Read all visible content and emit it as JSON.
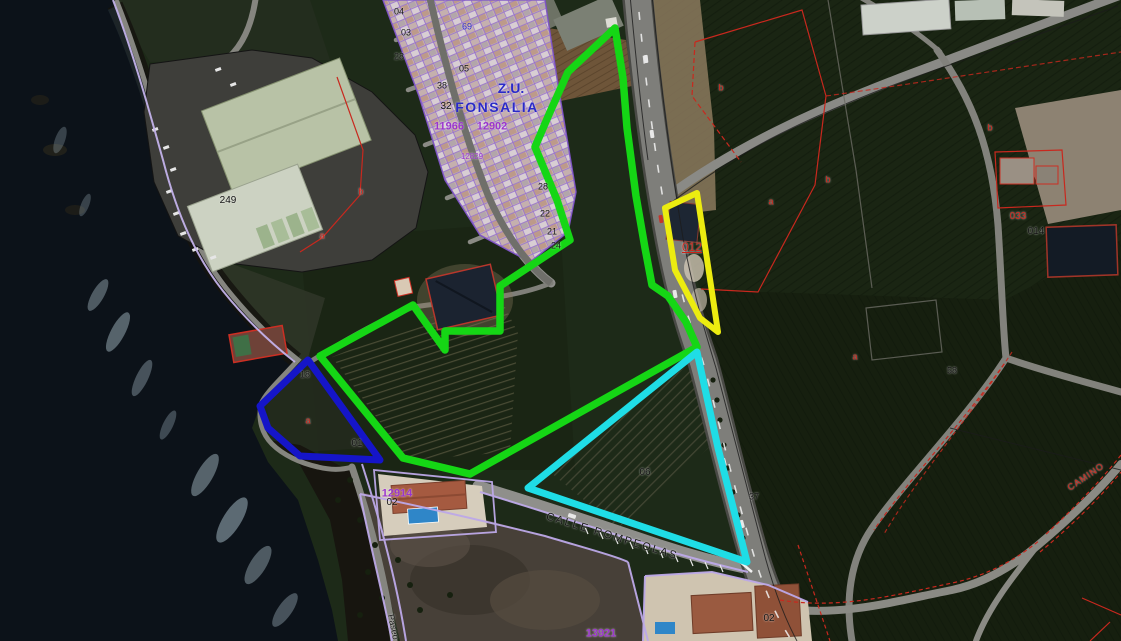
{
  "map": {
    "zone_label": "Z.U. FONSALIA",
    "parcels": [
      {
        "id": "green",
        "color": "#15d615"
      },
      {
        "id": "cyan",
        "color": "#1fdde6"
      },
      {
        "id": "yellow",
        "color": "#ecec10"
      },
      {
        "id": "blue",
        "color": "#1515c8"
      }
    ],
    "labels": [
      {
        "text": "Z.U.",
        "x": 511,
        "y": 88,
        "color": "#2a2ac8",
        "size": 14,
        "bold": true
      },
      {
        "text": "FONSALIA",
        "x": 497,
        "y": 107,
        "color": "#2a2ac8",
        "size": 14,
        "bold": true,
        "spacing": 1.5
      },
      {
        "text": "69",
        "x": 467,
        "y": 27,
        "color": "#2a2ac8",
        "size": 9
      },
      {
        "text": "11966",
        "x": 449,
        "y": 127,
        "color": "#9a35cc",
        "size": 11,
        "bold": true
      },
      {
        "text": "12902",
        "x": 492,
        "y": 127,
        "color": "#9a35cc",
        "size": 11,
        "bold": true
      },
      {
        "text": "12829",
        "x": 472,
        "y": 157,
        "color": "#9a35cc",
        "size": 8
      },
      {
        "text": "04",
        "x": 399,
        "y": 12,
        "color": "#111111",
        "size": 9
      },
      {
        "text": "03",
        "x": 406,
        "y": 33,
        "color": "#111111",
        "size": 9
      },
      {
        "text": "28",
        "x": 399,
        "y": 57,
        "color": "#111111",
        "size": 9
      },
      {
        "text": "05",
        "x": 464,
        "y": 69,
        "color": "#111111",
        "size": 9
      },
      {
        "text": "38",
        "x": 442,
        "y": 86,
        "color": "#111111",
        "size": 9
      },
      {
        "text": "32",
        "x": 446,
        "y": 107,
        "color": "#111111",
        "size": 10
      },
      {
        "text": "28",
        "x": 543,
        "y": 187,
        "color": "#111111",
        "size": 9
      },
      {
        "text": "22",
        "x": 545,
        "y": 214,
        "color": "#111111",
        "size": 9
      },
      {
        "text": "21",
        "x": 552,
        "y": 232,
        "color": "#111111",
        "size": 9
      },
      {
        "text": "24",
        "x": 556,
        "y": 246,
        "color": "#111111",
        "size": 9
      },
      {
        "text": "249",
        "x": 228,
        "y": 201,
        "color": "#111111",
        "size": 10
      },
      {
        "text": "b",
        "x": 361,
        "y": 192,
        "color": "#cc2218",
        "size": 9
      },
      {
        "text": "a",
        "x": 322,
        "y": 236,
        "color": "#cc2218",
        "size": 9
      },
      {
        "text": "012",
        "x": 692,
        "y": 247,
        "color": "#cc2218",
        "size": 12,
        "underline": true
      },
      {
        "text": "a",
        "x": 771,
        "y": 202,
        "color": "#cc2218",
        "size": 9
      },
      {
        "text": "b",
        "x": 721,
        "y": 88,
        "color": "#cc2218",
        "size": 9
      },
      {
        "text": "b",
        "x": 828,
        "y": 180,
        "color": "#cc2218",
        "size": 9
      },
      {
        "text": "a",
        "x": 855,
        "y": 357,
        "color": "#cc2218",
        "size": 9
      },
      {
        "text": "58",
        "x": 952,
        "y": 371,
        "color": "#111111",
        "size": 9
      },
      {
        "text": "b",
        "x": 990,
        "y": 128,
        "color": "#cc2218",
        "size": 9
      },
      {
        "text": "033",
        "x": 1018,
        "y": 217,
        "color": "#cc2218",
        "size": 10
      },
      {
        "text": "014",
        "x": 1036,
        "y": 232,
        "color": "#111111",
        "size": 10
      },
      {
        "text": "06",
        "x": 645,
        "y": 473,
        "color": "#111111",
        "size": 10
      },
      {
        "text": "37",
        "x": 754,
        "y": 497,
        "color": "#111111",
        "size": 9
      },
      {
        "text": "18",
        "x": 305,
        "y": 375,
        "color": "#111111",
        "size": 9
      },
      {
        "text": "a",
        "x": 308,
        "y": 421,
        "color": "#cc2218",
        "size": 9
      },
      {
        "text": "01",
        "x": 357,
        "y": 444,
        "color": "#111111",
        "size": 10
      },
      {
        "text": "12914",
        "x": 397,
        "y": 494,
        "color": "#9a35cc",
        "size": 11,
        "bold": true
      },
      {
        "text": "02",
        "x": 392,
        "y": 503,
        "color": "#111111",
        "size": 10
      },
      {
        "text": "13921",
        "x": 601,
        "y": 634,
        "color": "#9a35cc",
        "size": 11,
        "bold": true
      },
      {
        "text": "02",
        "x": 769,
        "y": 619,
        "color": "#111111",
        "size": 10
      },
      {
        "text": "CALLE ROMPEOLAS",
        "x": 612,
        "y": 537,
        "color": "#161616",
        "size": 11,
        "rot": 17,
        "spacing": 2
      },
      {
        "text": "CAMINO",
        "x": 1086,
        "y": 477,
        "color": "#cc2218",
        "size": 9,
        "rot": -34,
        "spacing": 1
      },
      {
        "text": "Paseo",
        "x": 393,
        "y": 627,
        "color": "#161616",
        "size": 9,
        "rot": 78
      }
    ]
  }
}
